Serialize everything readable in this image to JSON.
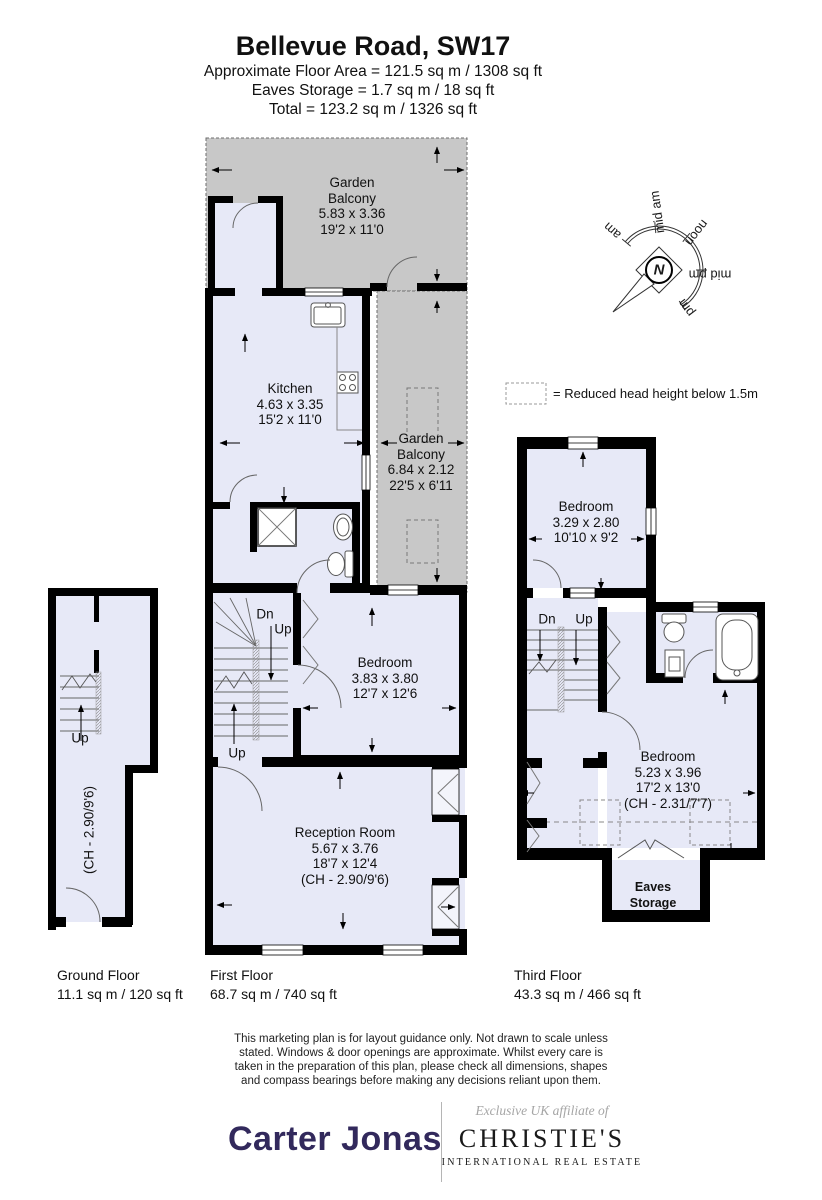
{
  "header": {
    "title": "Bellevue Road, SW17",
    "line1": "Approximate Floor Area = 121.5 sq m / 1308 sq ft",
    "line2": "Eaves Storage = 1.7 sq m / 18 sq ft",
    "line3": "Total = 123.2 sq m / 1326 sq ft"
  },
  "compass": {
    "labels": {
      "am": "am",
      "mid_am": "mid am",
      "noon": "noon",
      "mid_pm": "mid pm",
      "pm": "pm"
    },
    "north": "N"
  },
  "legend": {
    "text": "= Reduced head height below 1.5m"
  },
  "first_floor": {
    "garden_balcony_top": {
      "lines": [
        "Garden",
        "Balcony",
        "5.83 x 3.36",
        "19'2 x 11'0"
      ]
    },
    "kitchen": {
      "lines": [
        "Kitchen",
        "4.63 x 3.35",
        "15'2 x 11'0"
      ]
    },
    "garden_balcony_side": {
      "lines": [
        "Garden",
        "Balcony",
        "6.84 x 2.12",
        "22'5 x 6'11"
      ]
    },
    "bedroom": {
      "lines": [
        "Bedroom",
        "3.83 x 3.80",
        "12'7 x 12'6"
      ]
    },
    "reception": {
      "lines": [
        "Reception Room",
        "5.67 x 3.76",
        "18'7 x 12'4",
        "(CH - 2.90/9'6)"
      ]
    },
    "stair_dn": "Dn",
    "stair_up": "Up",
    "stair_up2": "Up"
  },
  "ground_floor": {
    "up": "Up",
    "ch": "(CH - 2.90/9'6)"
  },
  "third_floor": {
    "bedroom_small": {
      "lines": [
        "Bedroom",
        "3.29 x 2.80",
        "10'10 x 9'2"
      ]
    },
    "bedroom_large": {
      "lines": [
        "Bedroom",
        "5.23 x 3.96",
        "17'2 x 13'0",
        "(CH - 2.31/7'7)"
      ]
    },
    "eaves": {
      "lines": [
        "Eaves",
        "Storage"
      ]
    },
    "dn": "Dn",
    "up": "Up"
  },
  "floor_labels": {
    "ground": {
      "name": "Ground Floor",
      "area": "11.1 sq m / 120 sq ft"
    },
    "first": {
      "name": "First Floor",
      "area": "68.7 sq m / 740 sq ft"
    },
    "third": {
      "name": "Third Floor",
      "area": "43.3 sq m / 466 sq ft"
    }
  },
  "disclaimer": {
    "lines": [
      "This marketing plan is for layout guidance only. Not drawn to scale unless",
      "stated. Windows & door openings are approximate. Whilst every care is",
      "taken in the preparation of this plan, please check all dimensions, shapes",
      "and compass bearings before making any decisions reliant upon them."
    ]
  },
  "footer": {
    "carter_jonas": "Carter Jonas",
    "affiliate": "Exclusive UK affiliate of",
    "christies": "CHRISTIE'S",
    "christies_sub": "INTERNATIONAL REAL ESTATE"
  },
  "colors": {
    "room_fill": "#e7e9f7",
    "balcony_fill": "#c8c8c8",
    "wall": "#000000",
    "brand_navy": "#32295c"
  }
}
